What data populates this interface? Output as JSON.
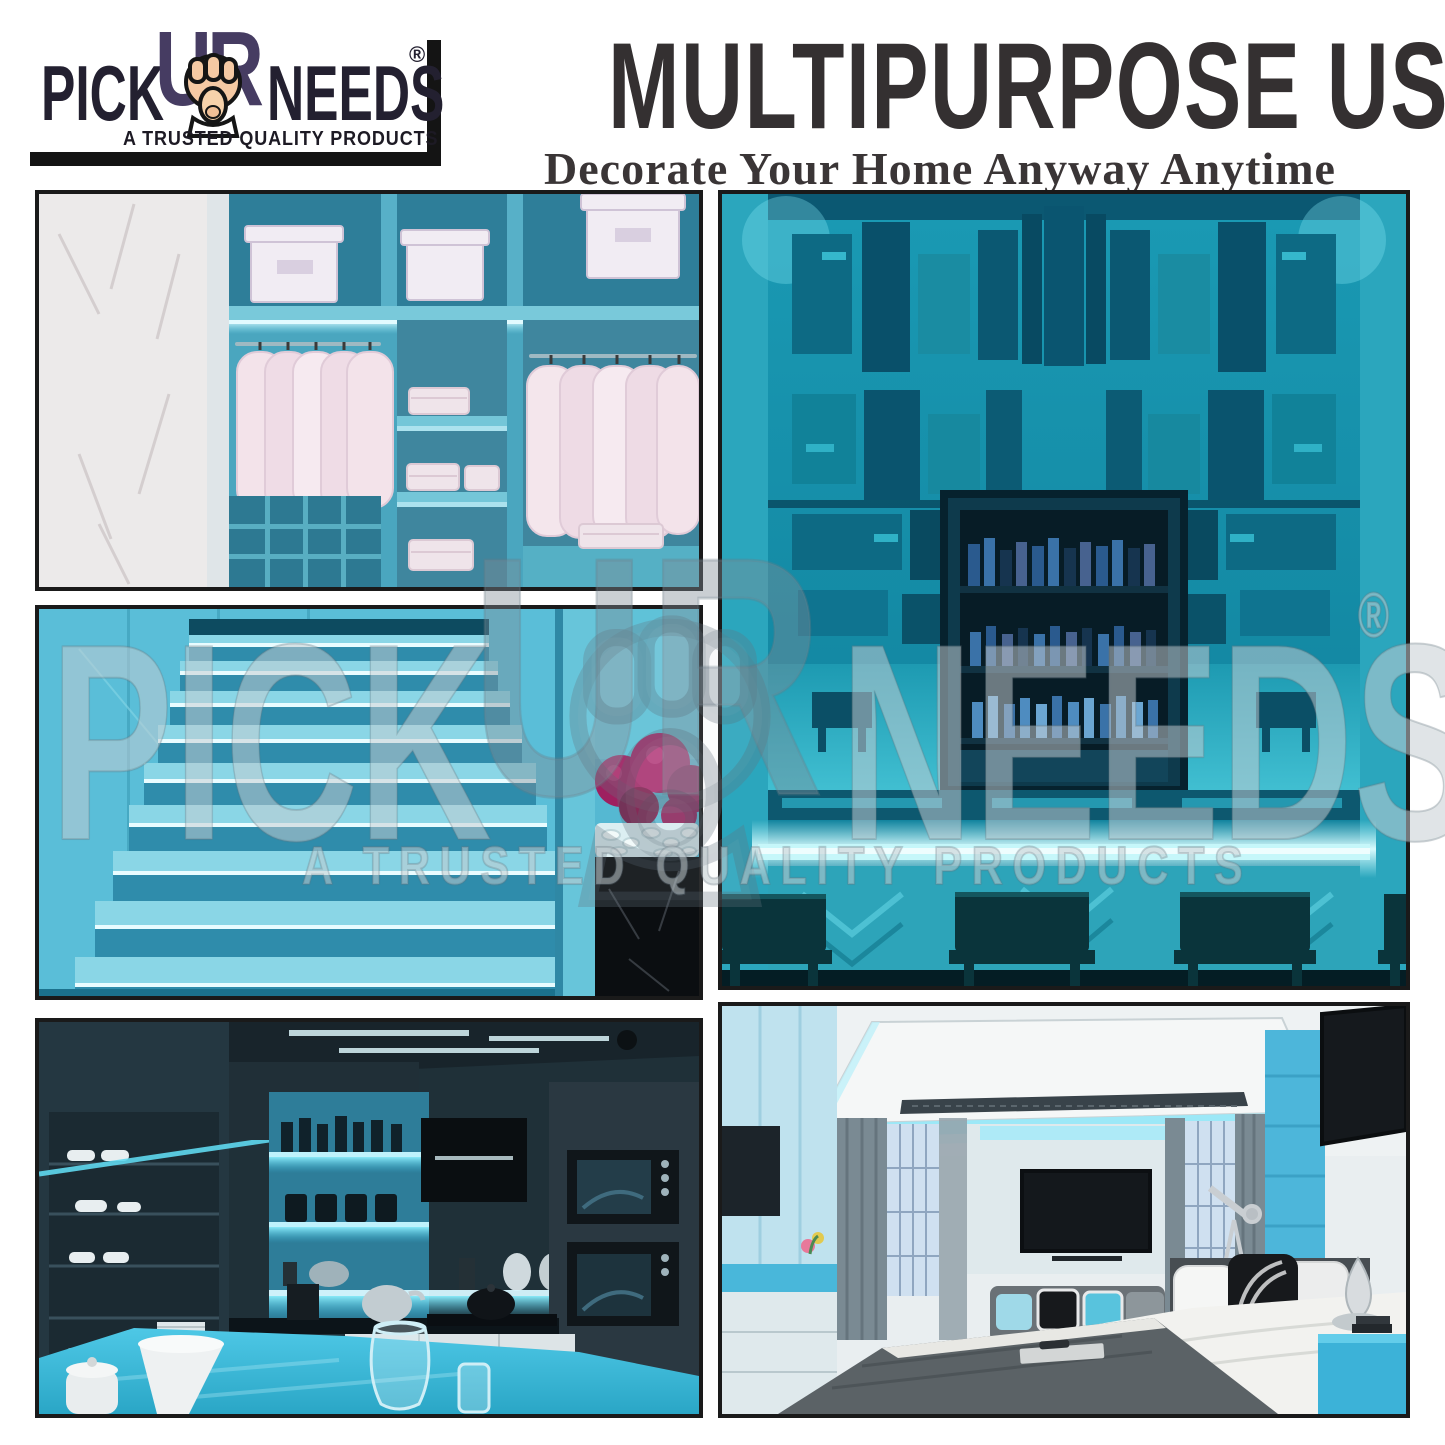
{
  "poster": {
    "background": "#ffffff",
    "panel_border_color": "#1a1a1a"
  },
  "brand": {
    "pick": "PICK",
    "ur": "UR",
    "needs": "NEEDS",
    "registered": "®",
    "tagline": "A TRUSTED QUALITY PRODUCTS"
  },
  "header": {
    "title": "MULTIPURPOSE USE",
    "subtitle": "Decorate Your Home Anyway Anytime"
  },
  "watermark": {
    "pick": "PICK",
    "ur": "UR",
    "needs": "NEEDS",
    "registered": "®",
    "tagline": "A TRUSTED QUALITY PRODUCTS"
  },
  "gallery": {
    "panels": [
      {
        "id": "closet",
        "label": "Walk-in wardrobe with cyan LED strip lighting, hanging shirts, storage boxes and marble wall"
      },
      {
        "id": "stairs",
        "label": "Staircase with LED strip lighting under each step and black marble planter with pebbles"
      },
      {
        "id": "kitchen",
        "label": "Modern dark kitchen with cyan LED under-shelf and under-cabinet lighting"
      },
      {
        "id": "bar",
        "label": "Bar with teal LED-lit art deco back wall, liquor cabinet and glowing counter with stools"
      },
      {
        "id": "bedroom",
        "label": "Bedroom with cyan LED cove ceiling lighting, wall TV, telescope and blue nightstand"
      }
    ]
  },
  "colors": {
    "accent_cyan": "#57d6f0",
    "teal": "#1797b2",
    "led_glow": "#c6f7fa",
    "magenta_accent": "#9e2060",
    "title_text": "#343031",
    "logo_text": "#232030",
    "logo_ur": "#463c62",
    "hand_skin": "#f5c9a3"
  }
}
